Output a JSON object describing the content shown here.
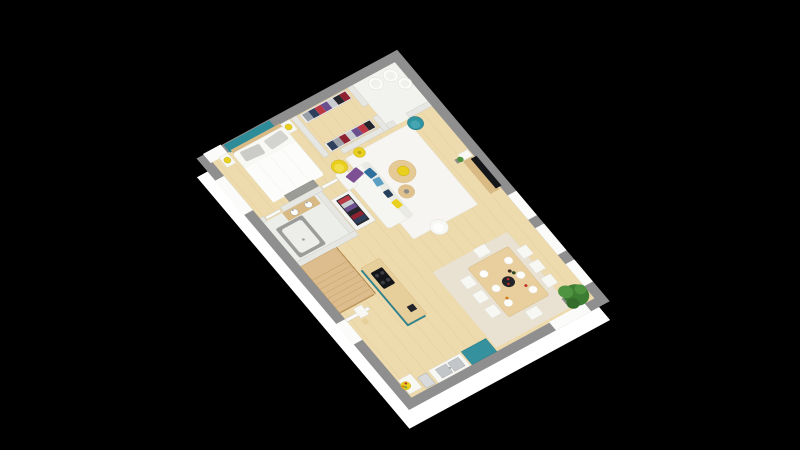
{
  "scene": {
    "type": "3d-floor-plan-render",
    "view": "isometric-top-down",
    "storey": "single floor with staircase",
    "visible_text": ""
  },
  "rooms": [
    "bedroom",
    "walk-in-closet",
    "utility-room",
    "bathroom",
    "hallway",
    "entry-closet",
    "living-room",
    "dining-area",
    "kitchen",
    "staircase"
  ],
  "furniture": [
    "double-bed",
    "nightstands",
    "bedside-lamps",
    "bench",
    "clothes-racks",
    "water-heater-cylinders",
    "bathtub",
    "vanity-basins",
    "sofa",
    "cushions",
    "coffee-tables",
    "tv-console",
    "tv",
    "lounge-chair",
    "teal-accent-chair",
    "yellow-armchair",
    "yellow-floor-lamp",
    "kitchen-island",
    "cooktop",
    "fridge",
    "kitchen-sink",
    "side-table",
    "fruit-bowl",
    "dining-table",
    "dining-chairs",
    "plates",
    "serving-tray",
    "wine-bottles",
    "potted-plant",
    "staircase-railing"
  ],
  "colors": {
    "background": "#000000",
    "wall_exterior_face": "#ffffff",
    "wall_exterior_top": "#8f8f8f",
    "wall_interior": "#e6e6e2",
    "wall_stroke": "#c7c7c2",
    "window_white": "#fbfbfa",
    "floor_wood": "#eddaad",
    "floor_wood_line": "#dcc18e",
    "floor_white": "#f2f2ef",
    "bathroom_floor": "#eceeea",
    "rug_white": "#f6f5f1",
    "rug_stroke": "#e7e5da",
    "rug_beige": "#e9e2d2",
    "teal": "#2f93a0",
    "teal_light": "#45a5b2",
    "teal_dark": "#23707c",
    "teal_wall": "#2e8b98",
    "teal_island": "#2c828f",
    "teal_fridge": "#35919e",
    "yellow": "#e9d01f",
    "yellow_light": "#f1de4a",
    "yellow_dark": "#c2a90f",
    "wood_furniture": "#e5ca96",
    "wood_dark": "#d9ba85",
    "counter_wood": "#e7cf9c",
    "table_wood": "#e8cf9d",
    "table_stroke": "#d2b279",
    "ctable2_wood": "#e0c28e",
    "stairs_wood": "#ddbd8d",
    "stairs_stroke": "#c19a5f",
    "rail_wood": "#b98d54",
    "white_furniture": "#f7f7f4",
    "furn_stroke": "#deded6",
    "plate_white": "#fdfdfb",
    "plate_stroke": "#e4e4de",
    "sofa_white": "#f5f5f1",
    "sofa_back": "#eaeae5",
    "pillow_blue": "#2e6f9e",
    "pillow_lightblue": "#5b9fc4",
    "pillow_navy": "#27405b",
    "throw_purple": "#7d4f93",
    "pillow_gray": "#d3d3d0",
    "pillow_gray2": "#cbcbc8",
    "bed_white": "#f8f8f5",
    "duvet_white": "#fcfcfa",
    "duvet_fold": "#ebebe6",
    "bench_gray": "#9b9b97",
    "bench_stroke": "#84847f",
    "tub_gray": "#9c9c9a",
    "tub_inner": "#ededea",
    "steel": "#c3c6c9",
    "steel_dark": "#9aa0a4",
    "appliance_gray": "#d8dadb",
    "cylinder_white": "#fbfbf8",
    "cylinder_stroke": "#d9d9d4",
    "cylinder_inner": "#f0f0ec",
    "black": "#141518",
    "black_soft": "#23242a",
    "burner_gray": "#3c3e44",
    "plant_green": "#3c7c33",
    "plant_green_light": "#4e9340",
    "plant_dark": "#336c2b",
    "pot_gray": "#8d8d89",
    "cloth_red": "#8f2230",
    "cloth_crimson": "#b93844",
    "cloth_black": "#24252b",
    "cloth_white": "#c9ccd1",
    "cloth_purple": "#6b4e8e",
    "cloth_navy": "#2e3f5c",
    "cloth_gray": "#9aa0a8",
    "cloth_rail_dark": "#2a2b31",
    "closet_base": "#f0efec",
    "closet_box": "#f4f4f1",
    "fruit_red": "#c03028",
    "fruit_green": "#7a9c2e",
    "fruit_orange": "#d07818",
    "bottle_dark": "#35231d",
    "bottle_green": "#2c4a28"
  }
}
